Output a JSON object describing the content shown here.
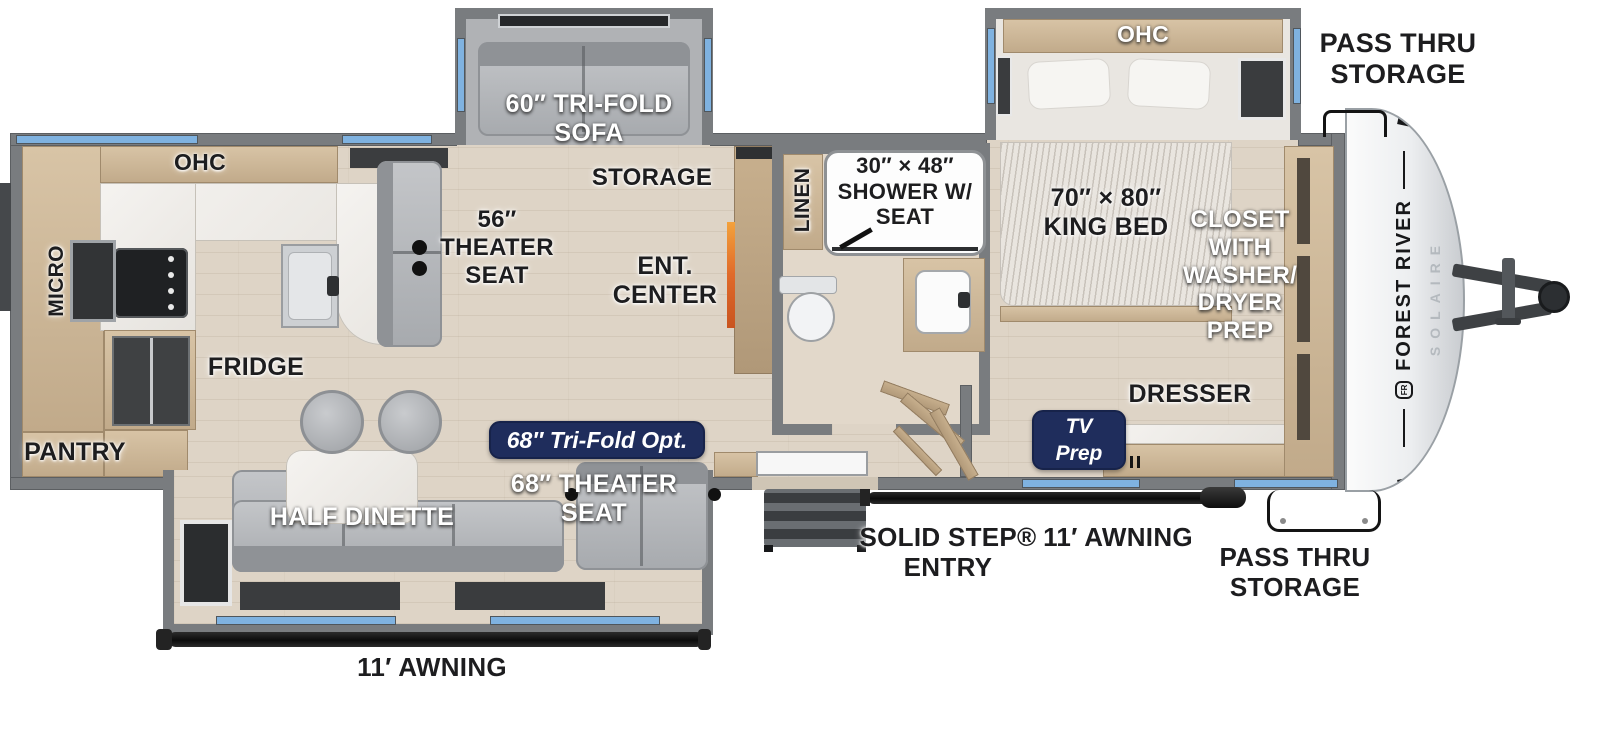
{
  "floorplan": {
    "brand": {
      "name": "FOREST RIVER",
      "model": "SOLAIRE",
      "crest": "FR"
    },
    "labels": {
      "ohc_bedroom": "OHC",
      "pass_thru_top": "PASS THRU\nSTORAGE",
      "tri_fold_sofa": "60″ TRI-FOLD\nSOFA",
      "storage": "STORAGE",
      "linen": "LINEN",
      "shower": "30″ × 48″\nSHOWER W/\nSEAT",
      "king_bed": "70″ × 80″\nKING BED",
      "closet": "CLOSET\nWITH\nWASHER/\nDRYER\nPREP",
      "ohc_kitchen": "OHC",
      "micro": "MICRO",
      "theater_seat_56": "56″\nTHEATER\nSEAT",
      "ent_center": "ENT.\nCENTER",
      "fridge": "FRIDGE",
      "pantry": "PANTRY",
      "half_dinette": "HALF DINETTE",
      "theater_seat_68": "68″ THEATER\nSEAT",
      "tri_fold_opt_badge": "68″ Tri-Fold Opt.",
      "tv_prep_badge": "TV\nPrep",
      "dresser": "DRESSER",
      "solid_step": "SOLID STEP®\nENTRY",
      "awning_right": "11′ AWNING",
      "pass_thru_bottom": "PASS THRU\nSTORAGE",
      "awning_left": "11′ AWNING"
    },
    "colors": {
      "wall_gray": "#797c7f",
      "floor_wood": "#ded4c6",
      "cabinet_wood": "#c9b294",
      "window_blue": "#7fb2e0",
      "badge_navy": "#1f2d5c",
      "fireplace_orange": "#e06a2a",
      "awning_black": "#141414",
      "label_black": "#1d1d1f",
      "label_white": "#ffffff"
    }
  }
}
